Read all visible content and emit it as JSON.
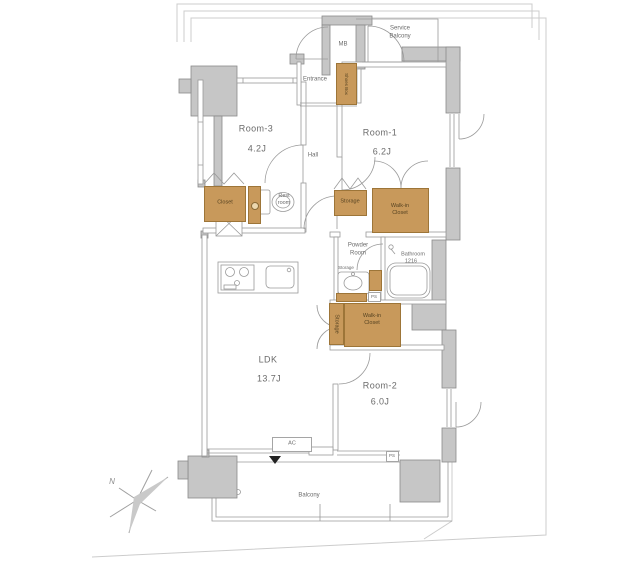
{
  "floorplan": {
    "rooms": {
      "room3": {
        "name": "Room-3",
        "size": "4.2J"
      },
      "room1": {
        "name": "Room-1",
        "size": "6.2J"
      },
      "room2": {
        "name": "Room-2",
        "size": "6.0J"
      },
      "ldk": {
        "name": "LDK",
        "size": "13.7J"
      },
      "hall": {
        "name": "Hall"
      },
      "entrance": {
        "name": "Entrance"
      },
      "balcony": {
        "name": "Balcony"
      },
      "service_balcony": {
        "name": "Service\nBalcony"
      },
      "rest_room": {
        "name": "Rest\nroom"
      },
      "powder_room": {
        "name": "Powder\nRoom"
      },
      "bathroom": {
        "name": "Bathroom",
        "size": "1216"
      }
    },
    "storage": {
      "closet": "Closet",
      "shoes_box": "Shoes Box",
      "storage_hall": "Storage",
      "storage_powder": "Storage",
      "storage_ldk": "Storage",
      "walk_in_closet_1": "Walk-in\nCloset",
      "walk_in_closet_2": "Walk-in\nCloset"
    },
    "annotations": {
      "mb": "MB",
      "ac": "AC",
      "ps_powder": "PS",
      "ps_room2": "PS",
      "north": "N"
    },
    "colors": {
      "wall_fill": "#c6c6c6",
      "wall_stroke": "#8a8a8a",
      "closet_fill": "#c8995b",
      "closet_stroke": "#9d7538",
      "line": "#9a9a9a",
      "boundary": "#cccccc",
      "text": "#6b6b6b"
    }
  }
}
